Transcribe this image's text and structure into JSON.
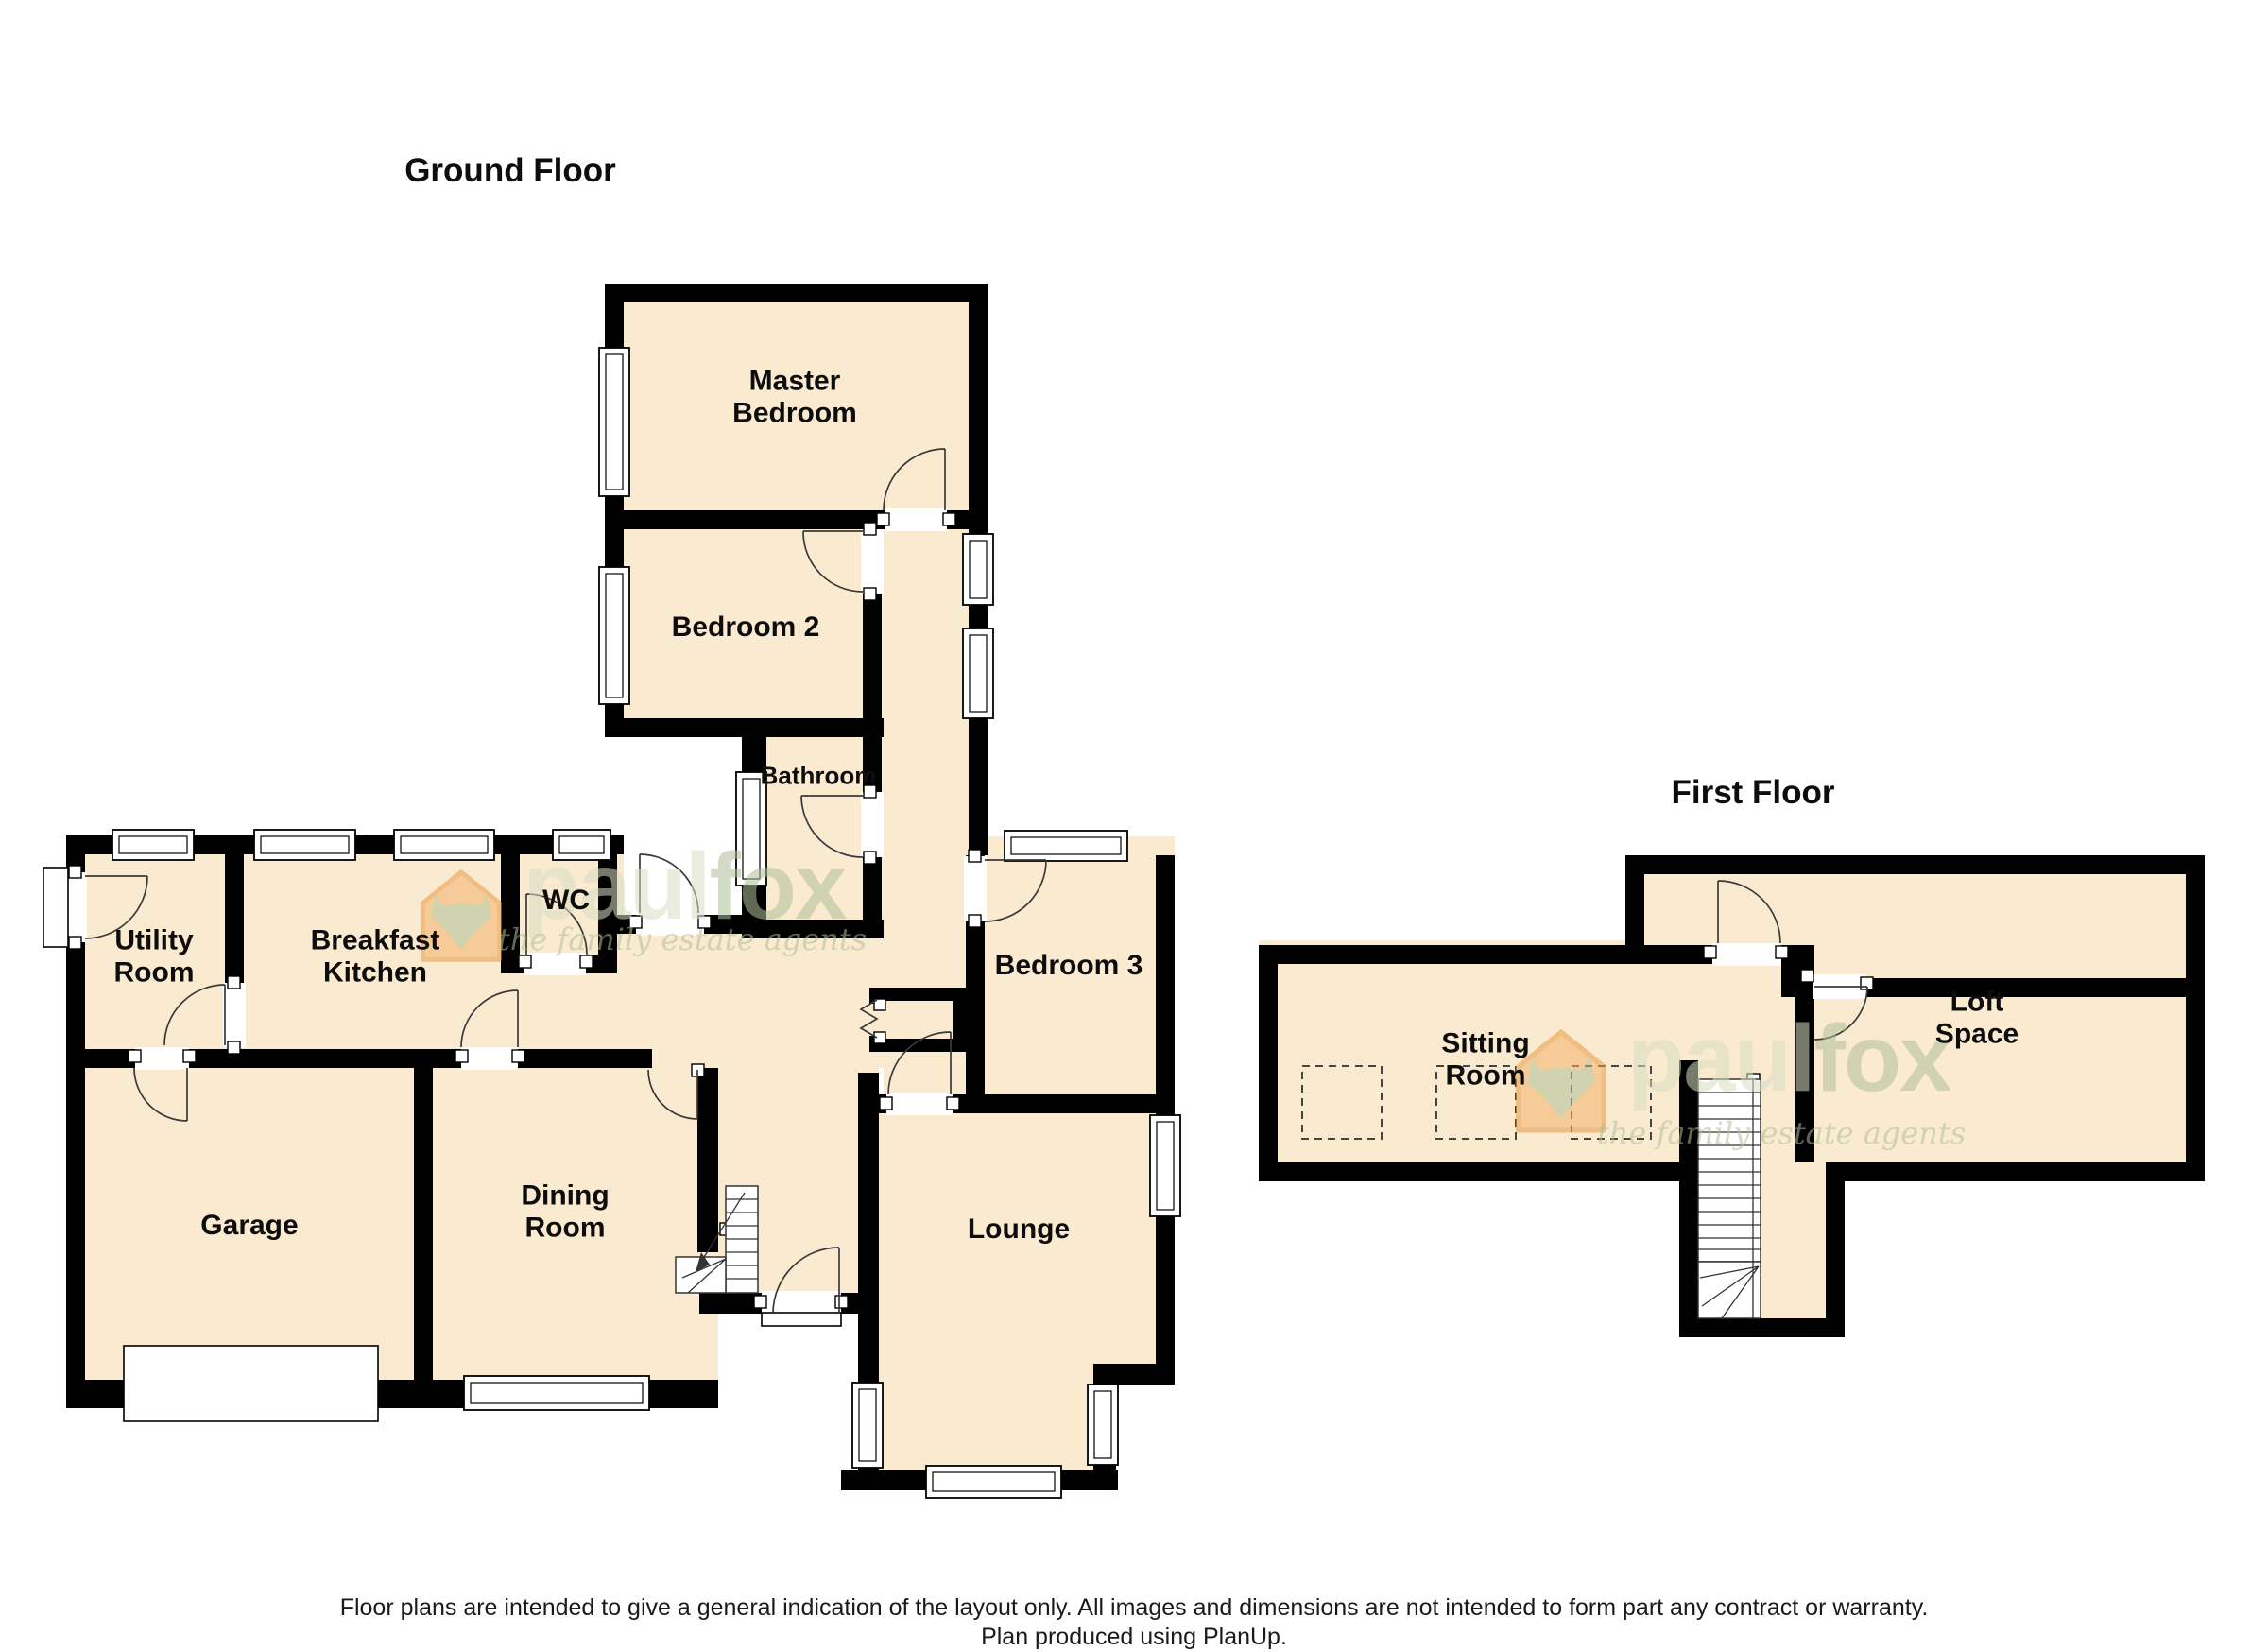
{
  "document": {
    "background": "#ffffff"
  },
  "titles": {
    "ground_floor": "Ground Floor",
    "first_floor": "First Floor"
  },
  "ground_floor_rooms": {
    "master_bedroom": {
      "l1": "Master",
      "l2": "Bedroom"
    },
    "bedroom2": {
      "l1": "Bedroom 2"
    },
    "bathroom": {
      "l1": "Bathroom"
    },
    "wc": {
      "l1": "WC"
    },
    "utility": {
      "l1": "Utility",
      "l2": "Room"
    },
    "kitchen": {
      "l1": "Breakfast",
      "l2": "Kitchen"
    },
    "garage": {
      "l1": "Garage"
    },
    "dining": {
      "l1": "Dining",
      "l2": "Room"
    },
    "lounge": {
      "l1": "Lounge"
    },
    "bedroom3": {
      "l1": "Bedroom 3"
    }
  },
  "first_floor_rooms": {
    "sitting_room": {
      "l1": "Sitting",
      "l2": "Room"
    },
    "loft_space": {
      "l1": "Loft",
      "l2": "Space"
    }
  },
  "watermark": {
    "part1": "paul",
    "part2": "fox",
    "tagline": "the family estate agents"
  },
  "footer": {
    "line1": "Floor plans are intended to give a general indication of the layout only. All images and dimensions are not intended to form part any contract or warranty.",
    "line2": "Plan produced using PlanUp."
  },
  "colors": {
    "room_fill": "#faead0",
    "wall": "#000000",
    "watermark_light": "#d9dfc4",
    "watermark_dark": "#aebf97",
    "logo_orange": "#f4b369",
    "logo_outline": "#e89a43"
  }
}
